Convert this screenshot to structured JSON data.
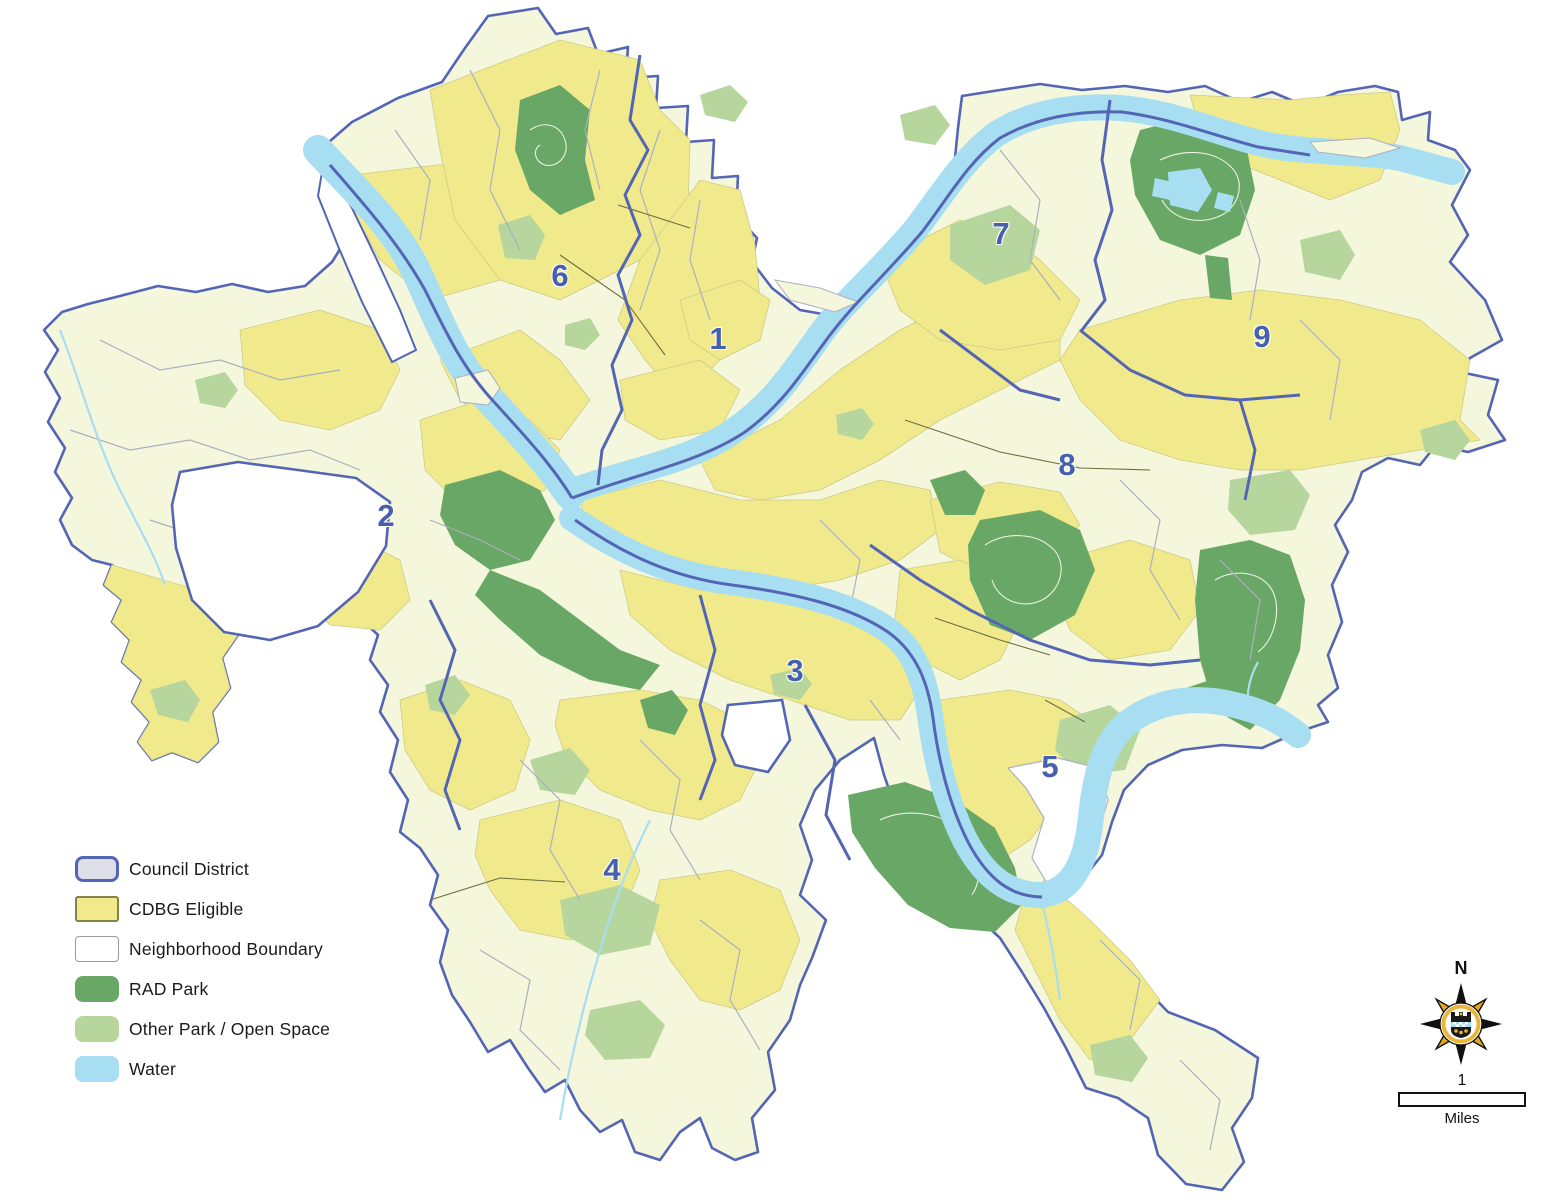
{
  "map": {
    "kind": "council-district-cdbg-map",
    "districts": [
      {
        "label": "1",
        "x": 718,
        "y": 341
      },
      {
        "label": "2",
        "x": 386,
        "y": 518
      },
      {
        "label": "3",
        "x": 795,
        "y": 673
      },
      {
        "label": "4",
        "x": 612,
        "y": 872
      },
      {
        "label": "5",
        "x": 1050,
        "y": 769
      },
      {
        "label": "6",
        "x": 560,
        "y": 278
      },
      {
        "label": "7",
        "x": 1001,
        "y": 236
      },
      {
        "label": "8",
        "x": 1067,
        "y": 467
      },
      {
        "label": "9",
        "x": 1262,
        "y": 339
      }
    ],
    "colors": {
      "council_district_boundary": "#5365B4",
      "cdbg_eligible": "#F0EA8C",
      "neighborhood_boundary_line": "#AAB0C0",
      "rad_park": "#69A766",
      "other_park": "#B6D69D",
      "water": "#A8DEF2",
      "base_land": "#F4F7DB",
      "district_label": "#4560AF"
    }
  },
  "legend": {
    "items": [
      {
        "label": "Council District",
        "fill": "#DEDEE9",
        "border": "#5365B4"
      },
      {
        "label": "CDBG Eligible",
        "fill": "#F0EA8C",
        "border": "#84834C"
      },
      {
        "label": "Neighborhood Boundary",
        "fill": "#FFFFFF",
        "border": "#9A9A9A"
      },
      {
        "label": "RAD Park",
        "fill": "#69A766",
        "border": "none"
      },
      {
        "label": "Other Park / Open Space",
        "fill": "#B6D69D",
        "border": "none"
      },
      {
        "label": "Water",
        "fill": "#A8DEF2",
        "border": "none"
      }
    ]
  },
  "compass": {
    "north_label": "N"
  },
  "scale_bar": {
    "value": "1",
    "unit": "Miles"
  }
}
